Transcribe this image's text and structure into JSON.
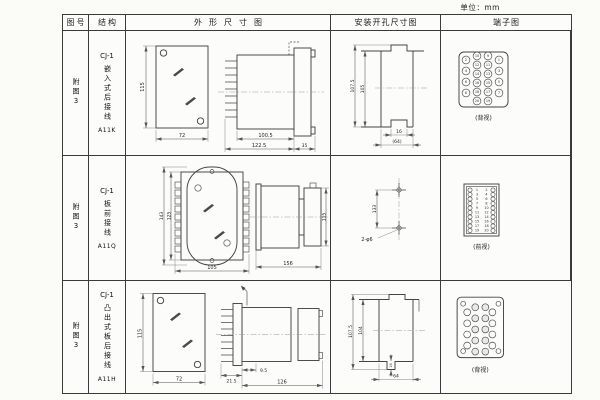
{
  "unit_label": "单位：mm",
  "header": {
    "fig": "图号",
    "struct": "结构",
    "outline": "外形尺寸图",
    "mount": "安装开孔尺寸图",
    "terminal": "端子图"
  },
  "rows": [
    {
      "fig": "附图3",
      "model": "CJ-1",
      "struct": "嵌入式后接线",
      "code": "A11K",
      "outline": {
        "h": "115",
        "w": "72",
        "a": "100.5",
        "b": "122.5",
        "c": "35"
      },
      "mount": {
        "v1": "107.5",
        "v2": "105",
        "n": "16",
        "w": "(64)"
      },
      "terminal": {
        "view": "(背视)",
        "outer_left": [
          "2",
          "4",
          "6",
          "8"
        ],
        "mid_left": [
          "10",
          "12",
          "14",
          "16",
          "18",
          "20"
        ],
        "mid_right": [
          "9",
          "11",
          "13",
          "15",
          "17",
          "19"
        ],
        "outer_right": [
          "1",
          "3",
          "5",
          "7"
        ]
      }
    },
    {
      "fig": "附图3",
      "model": "CJ-1",
      "struct": "板前接线",
      "code": "A11Q",
      "outline": {
        "h1": "143",
        "h2": "125",
        "w": "105",
        "len": "156",
        "sh": "115"
      },
      "mount": {
        "spacing": "133",
        "note": "2-φ6"
      },
      "terminal": {
        "view": "(前视)",
        "left": [
          "1",
          "3",
          "5",
          "7",
          "9",
          "11",
          "13",
          "15",
          "17",
          "19"
        ],
        "right": [
          "2",
          "4",
          "6",
          "8",
          "10",
          "12",
          "14",
          "16",
          "18",
          "20"
        ]
      }
    },
    {
      "fig": "附图3",
      "model": "CJ-1",
      "struct": "凸出式板后接线",
      "code": "A11H",
      "outline": {
        "h": "115",
        "w": "72",
        "a": "21.5",
        "b": "9.5",
        "c": "126"
      },
      "mount": {
        "v1": "107.5",
        "v2": "104",
        "n": "16",
        "w": "64"
      },
      "terminal": {
        "view": "(背视)"
      }
    }
  ]
}
